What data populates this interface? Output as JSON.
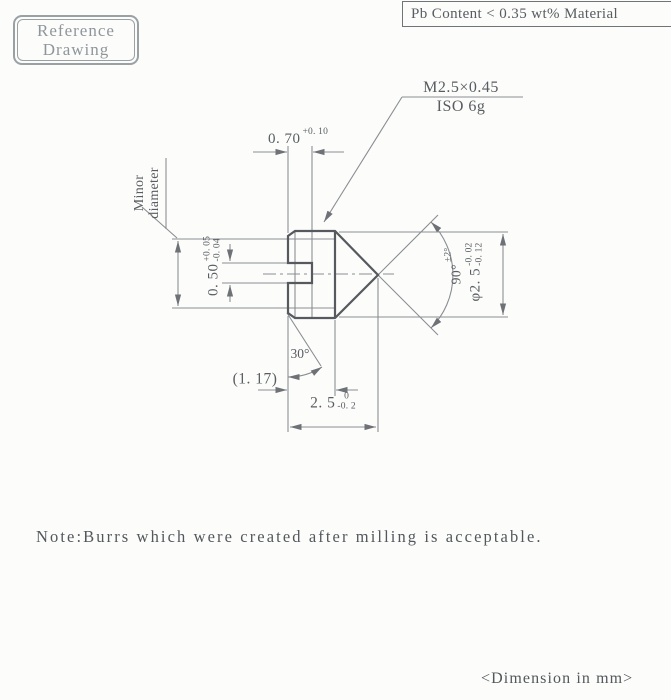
{
  "colors": {
    "background": "#fcfcfb",
    "outline_line": "#565a5e",
    "thin_line": "#8a8e92",
    "text": "#585d61",
    "stamp": "#8f969b"
  },
  "stamp": {
    "line1": "Reference",
    "line2": "Drawing"
  },
  "material_note": "Pb Content < 0.35 wt% Material",
  "thread_callout": {
    "designation": "M2.5×0.45",
    "tolerance_class": "ISO 6g"
  },
  "dimensions": {
    "slot_depth": {
      "value": "0. 70",
      "tol_upper": "+0. 10"
    },
    "slot_width": {
      "value": "0. 50",
      "tol_upper": "+0. 05",
      "tol_lower": "-0. 04"
    },
    "minor_diameter_label": {
      "line1": "Minor",
      "line2": "diameter"
    },
    "point_angle": {
      "value": "90°",
      "tol": "±2°"
    },
    "outer_diameter": {
      "value": "φ2. 5",
      "tol_upper": "-0. 02",
      "tol_lower": "-0. 12"
    },
    "head_length_ref": "(1. 17)",
    "chamfer_angle": "30°",
    "overall_length": {
      "value": "2. 5",
      "tol_upper": "0",
      "tol_lower": "-0. 2"
    }
  },
  "note": "Note:Burrs which were created after milling is acceptable.",
  "units_note": "<Dimension in mm>"
}
